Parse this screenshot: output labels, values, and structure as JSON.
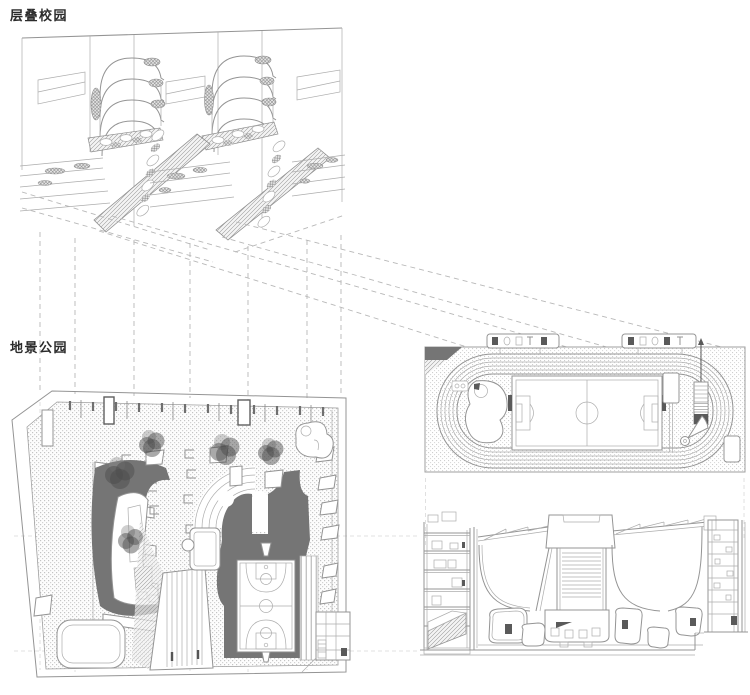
{
  "labels": {
    "layered_campus": "层叠校园",
    "landscape_park": "地景公园"
  },
  "drawings": {
    "layered_campus_label": "层叠校园",
    "landscape_park_label": "地景公园"
  },
  "colors": {
    "background": "#ffffff",
    "line": "#949494",
    "line_light": "#adadad",
    "dashed": "#b8b8b8",
    "dark_fill": "#757575",
    "dark_accent": "#5a5a5a",
    "tree": "#4c4c4c",
    "label_text": "#2b2b2b"
  }
}
